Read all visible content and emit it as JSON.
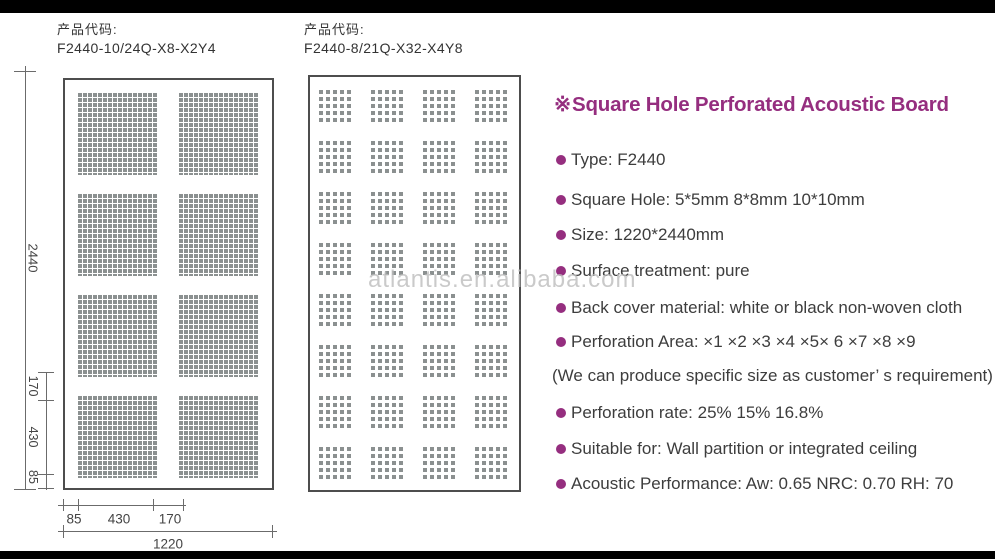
{
  "page": {
    "watermark": "atlantis.en.alibaba.com"
  },
  "diagrams": [
    {
      "label": "产品代码:",
      "code": "F2440-10/24Q-X8-X2Y4",
      "grid": {
        "cols": 2,
        "rows": 4
      },
      "dims": {
        "total_height": "2440",
        "left_segments": [
          "170",
          "430",
          "85"
        ],
        "bottom_segments": [
          "85",
          "430",
          "170"
        ],
        "total_width": "1220"
      }
    },
    {
      "label": "产品代码:",
      "code": "F2440-8/21Q-X32-X4Y8",
      "grid": {
        "cols": 4,
        "rows": 8
      }
    }
  ],
  "specs": {
    "title_marker": "※",
    "title": "Square Hole Perforated Acoustic Board",
    "items": [
      {
        "bullet": true,
        "text": "Type: F2440"
      },
      {
        "bullet": true,
        "text": "Square Hole: 5*5mm 8*8mm 10*10mm"
      },
      {
        "bullet": true,
        "text": "Size: 1220*2440mm"
      },
      {
        "bullet": true,
        "text": "Surface treatment: pure"
      },
      {
        "bullet": true,
        "text": "Back cover material: white or black non-woven cloth"
      },
      {
        "bullet": true,
        "text": "Perforation Area: ×1 ×2 ×3 ×4 ×5× 6 ×7 ×8 ×9"
      },
      {
        "bullet": false,
        "text": "(We can produce specific size as customer’ s requirement)"
      },
      {
        "bullet": true,
        "text": "Perforation rate: 25% 15% 16.8%"
      },
      {
        "bullet": true,
        "text": "Suitable for: Wall partition or integrated ceiling"
      },
      {
        "bullet": true,
        "text": "Acoustic Performance: Aw: 0.65  NRC: 0.70  RH: 70"
      }
    ],
    "colors": {
      "accent": "#952e7f",
      "text": "#3d3d3d"
    }
  }
}
